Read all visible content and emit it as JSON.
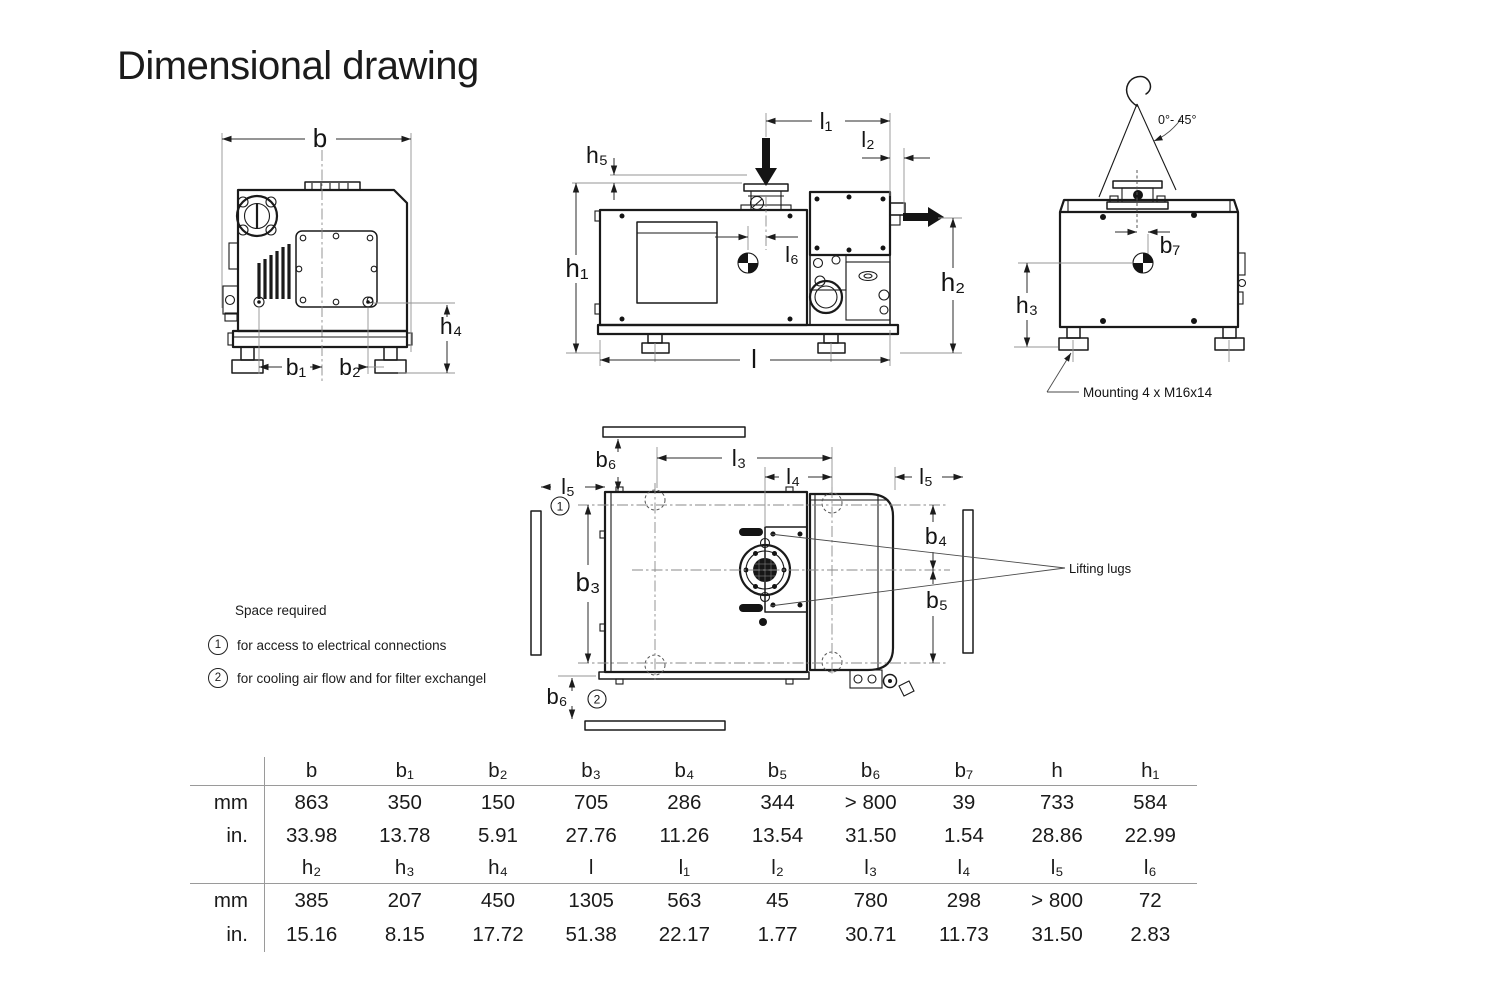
{
  "title": "Dimensional drawing",
  "labels": {
    "b": "b",
    "b1": "b₁",
    "b2": "b₂",
    "b3": "b₃",
    "b4": "b₄",
    "b5": "b₅",
    "b6": "b₆",
    "b7": "b₇",
    "h1": "h₁",
    "h2": "h₂",
    "h3": "h₃",
    "h4": "h₄",
    "h5": "h₅",
    "l": "l",
    "l1": "l₁",
    "l2": "l₂",
    "l3": "l₃",
    "l4": "l₄",
    "l5": "l₅",
    "l6": "l₆",
    "angle": "0°- 45°",
    "mounting": "Mounting 4 x M16x14",
    "lifting_lugs": "Lifting lugs"
  },
  "notes": {
    "heading": "Space required",
    "items": [
      {
        "num": "1",
        "text": "for access to electrical connections"
      },
      {
        "num": "2",
        "text": "for cooling air flow and for filter exchangel"
      }
    ]
  },
  "table": {
    "rows": [
      {
        "kind": "header",
        "cells": [
          "",
          "b",
          "b₁",
          "b₂",
          "b₃",
          "b₄",
          "b₅",
          "b₆",
          "b₇",
          "h",
          "h₁"
        ]
      },
      {
        "kind": "values",
        "cells": [
          "mm",
          "863",
          "350",
          "150",
          "705",
          "286",
          "344",
          "> 800",
          "39",
          "733",
          "584"
        ]
      },
      {
        "kind": "values",
        "cells": [
          "in.",
          "33.98",
          "13.78",
          "5.91",
          "27.76",
          "11.26",
          "13.54",
          "31.50",
          "1.54",
          "28.86",
          "22.99"
        ]
      },
      {
        "kind": "header",
        "cells": [
          "",
          "h₂",
          "h₃",
          "h₄",
          "l",
          "l₁",
          "l₂",
          "l₃",
          "l₄",
          "l₅",
          "l₆"
        ]
      },
      {
        "kind": "values",
        "cells": [
          "mm",
          "385",
          "207",
          "450",
          "1305",
          "563",
          "45",
          "780",
          "298",
          "> 800",
          "72"
        ]
      },
      {
        "kind": "values",
        "cells": [
          "in.",
          "15.16",
          "8.15",
          "17.72",
          "51.38",
          "22.17",
          "1.77",
          "30.71",
          "11.73",
          "31.50",
          "2.83"
        ]
      }
    ]
  }
}
